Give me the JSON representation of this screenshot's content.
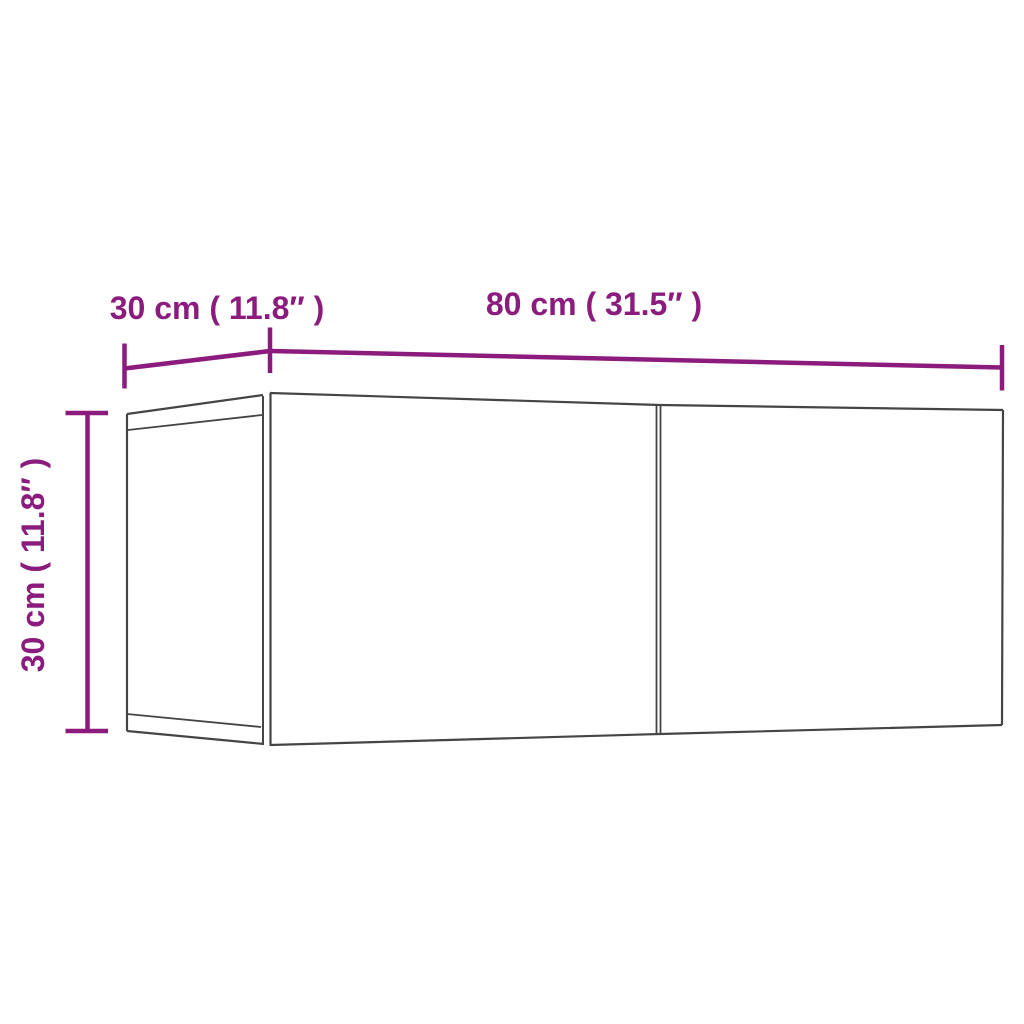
{
  "diagram": {
    "title": "cabinet-dimension-diagram",
    "labels": {
      "depth": "30 cm ( 11.8″ )",
      "width": "80 cm ( 31.5″ )",
      "height": "30 cm ( 11.8″ )"
    },
    "dimensions": {
      "depth_cm": 30,
      "depth_in": 11.8,
      "width_cm": 80,
      "width_in": 31.5,
      "height_cm": 30,
      "height_in": 11.8
    }
  },
  "colors": {
    "dimension_accent": "#8b1c7d",
    "cabinet_outline": "#454545",
    "background": "#ffffff"
  }
}
